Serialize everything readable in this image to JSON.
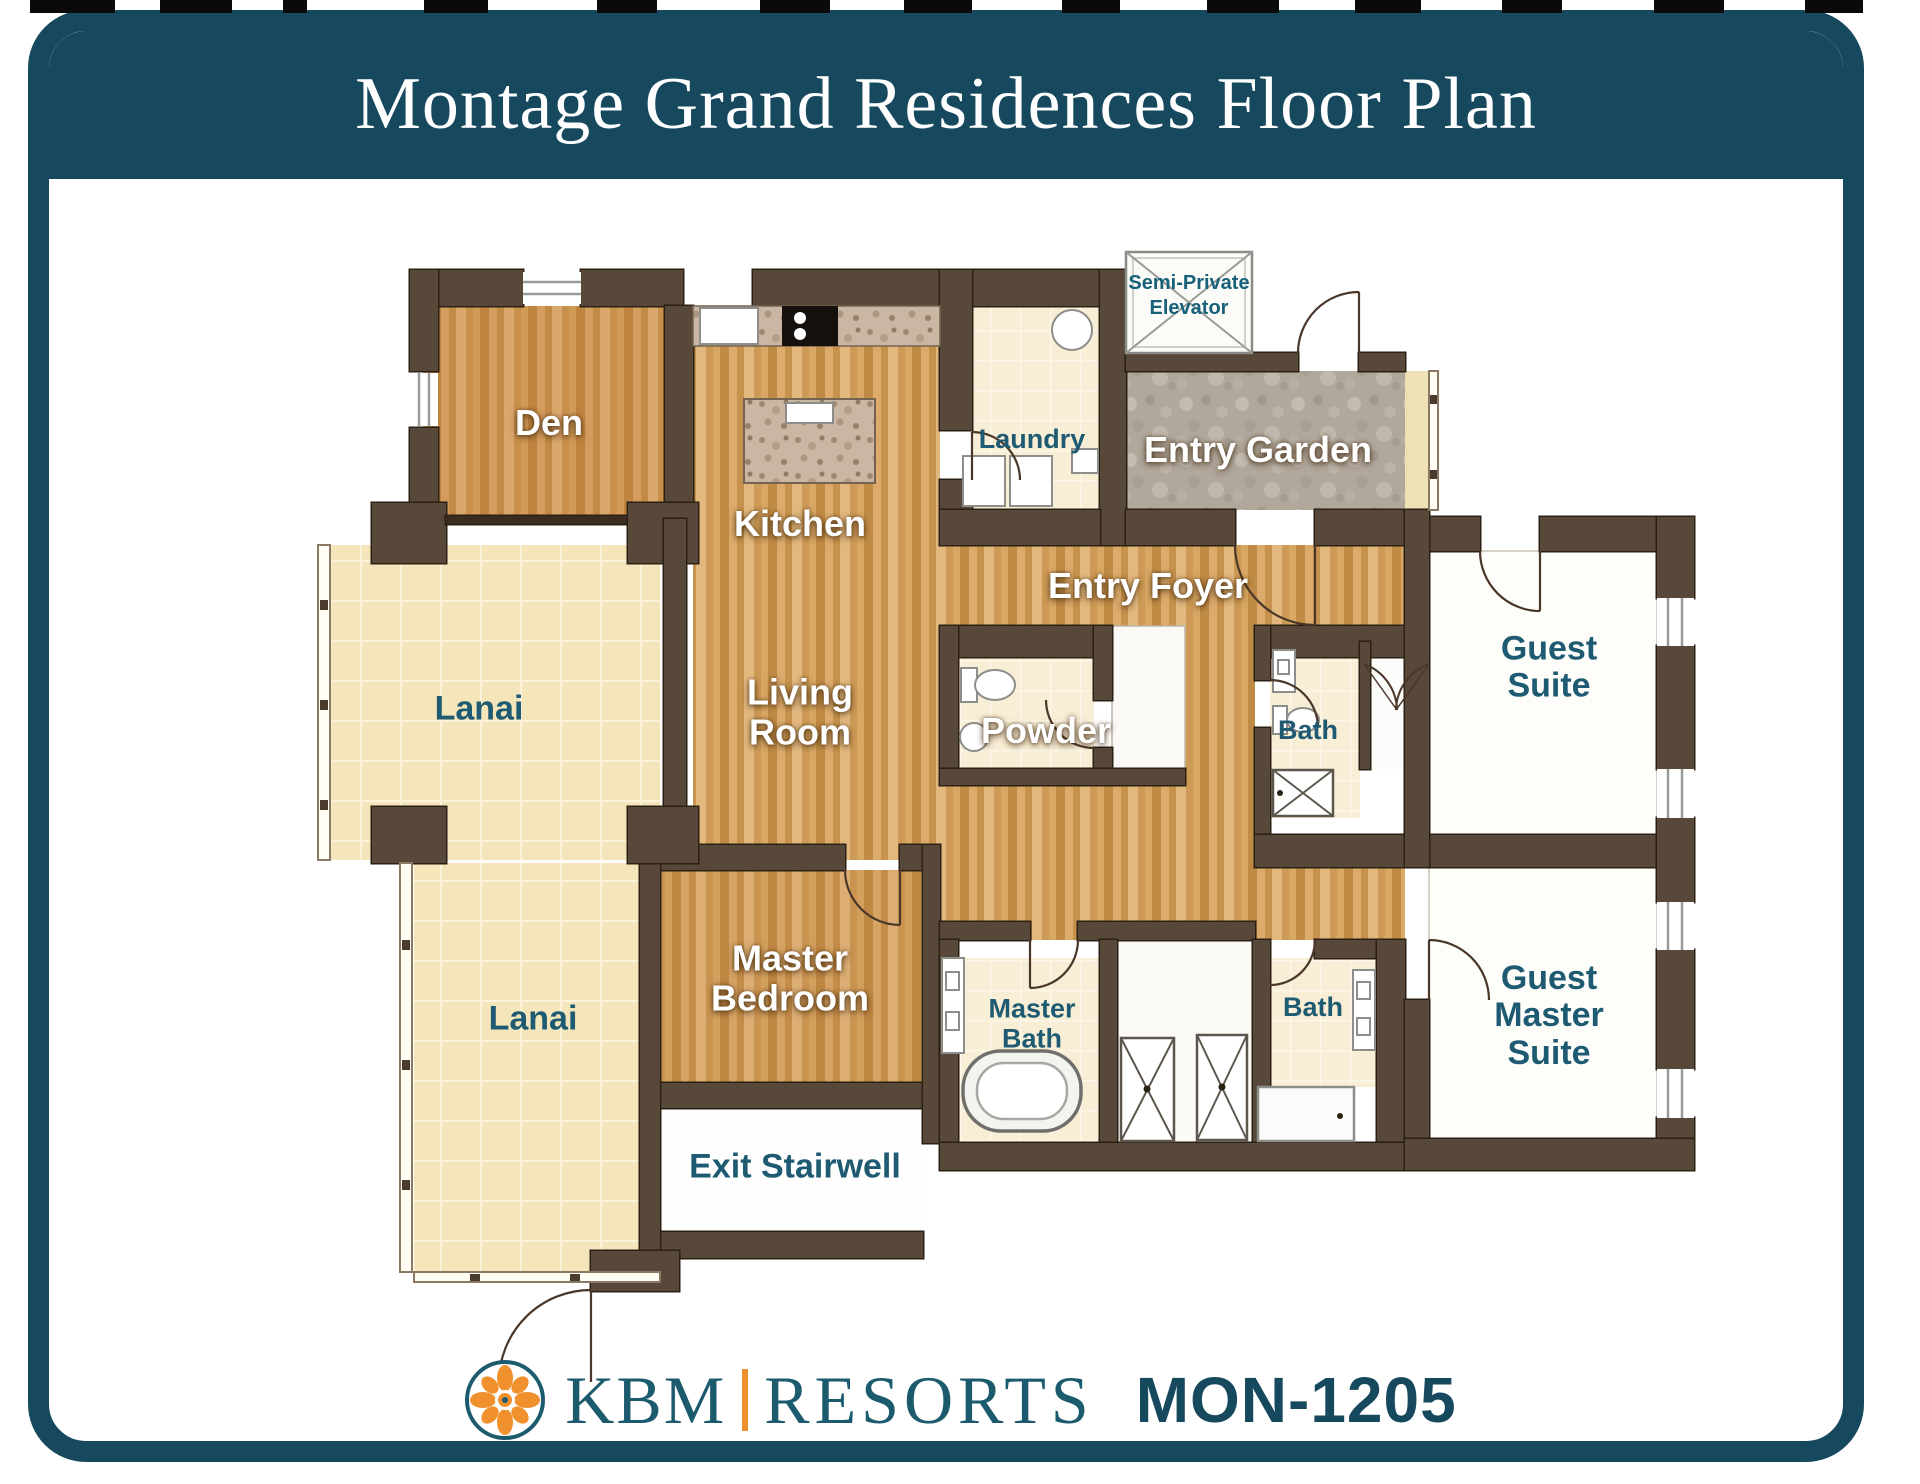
{
  "header": {
    "title": "Montage Grand Residences Floor Plan"
  },
  "plan": {
    "rooms": {
      "den": "Den",
      "kitchen": "Kitchen",
      "laundry": "Laundry",
      "elevator": "Semi-Private Elevator",
      "entry_garden": "Entry Garden",
      "entry_foyer": "Entry Foyer",
      "living_room": "Living Room",
      "powder": "Powder",
      "lanai_upper": "Lanai",
      "lanai_lower": "Lanai",
      "guest_bath": "Bath",
      "guest_suite": "Guest Suite",
      "master_bedroom": "Master Bedroom",
      "master_bath": "Master Bath",
      "bath_2": "Bath",
      "guest_master_suite": "Guest Master Suite",
      "exit_stairwell": "Exit Stairwell"
    }
  },
  "footer": {
    "brand_left": "KBM",
    "brand_right": "RESORTS",
    "unit_code": "MON-1205"
  },
  "colors": {
    "accent_teal": "#16495e",
    "label_teal": "#1e5b72",
    "wall_brown": "#57483a",
    "logo_orange": "#f0912d"
  }
}
